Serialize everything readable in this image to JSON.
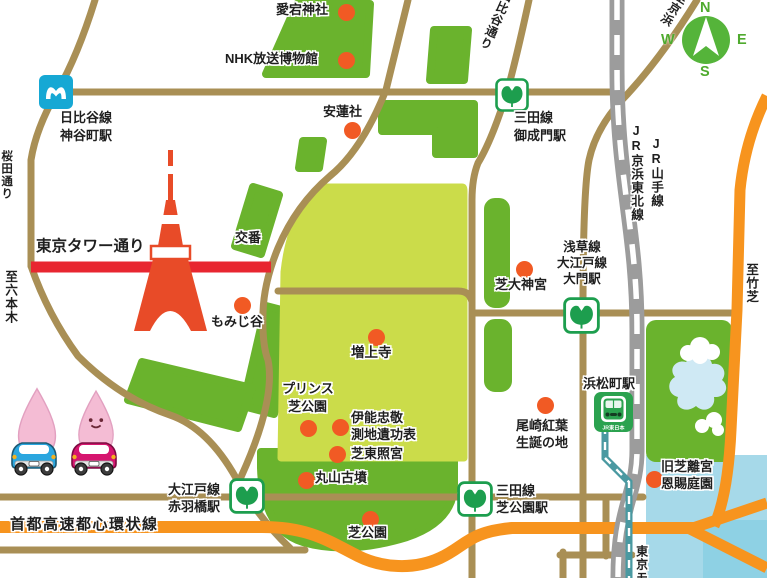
{
  "colors": {
    "park_green": "#6ab32d",
    "lawn_green": "#cbdc4a",
    "road_tan": "#a98f55",
    "red_road": "#e82630",
    "expressway_orange": "#f7941e",
    "water": "#a6d9e9",
    "water_deep": "#8ed1e4",
    "jr_rail_gray": "#9c9c9c",
    "monorail_teal": "#4a99a1",
    "metro_blue": "#16a8d4",
    "toei_green": "#1d9e4e",
    "jr_station_green": "#2ba24f",
    "compass_green": "#55b43a",
    "poi_dot_orange": "#f15a24",
    "tower_red": "#e84b28",
    "mascot_pink": "#f4bcd4",
    "car_blue": "#2aa6df",
    "car_pink": "#d6156f"
  },
  "compass": {
    "n": "N",
    "e": "E",
    "s": "S",
    "w": "W"
  },
  "streets": {
    "tokyo_tower_street": "東京タワー通り",
    "expressway": "首都高速都心環状線",
    "sakurada": "桜田通り",
    "hibiya": "日比谷通り",
    "to_roppongi": "至六本木",
    "to_takeshiba": "至竹芝",
    "to_keihin": "至京浜",
    "jr_keihin_tohoku": "JR京浜東北線",
    "jr_yamanote": "JR山手線",
    "monorail": "東京モ",
    "police_box": "交番"
  },
  "stations": {
    "kamiyacho": {
      "line": "日比谷線",
      "name": "神谷町駅"
    },
    "onarimon": {
      "line": "三田線",
      "name": "御成門駅"
    },
    "daimon": {
      "line1": "浅草線",
      "line2": "大江戸線",
      "name": "大門駅"
    },
    "akabanebashi": {
      "line": "大江戸線",
      "name": "赤羽橋駅"
    },
    "shibakoen": {
      "line": "三田線",
      "name": "芝公園駅"
    },
    "hamamatsucho": {
      "name": "浜松町駅",
      "operator": "JR東日本"
    }
  },
  "pois": {
    "atago": "愛宕神社",
    "nhk": "NHK放送博物館",
    "anrenja": "安蓮社",
    "shiba_daijingu": "芝大神宮",
    "momijidani": "もみじ谷",
    "zojoji": "増上寺",
    "prince1": "プリンス",
    "prince2": "芝公園",
    "inou1": "伊能忠敬",
    "inou2": "測地遺功表",
    "toshogu": "芝東照宮",
    "maruyama": "丸山古墳",
    "shibakoen_park": "芝公園",
    "ozaki1": "尾崎紅葉",
    "ozaki2": "生誕の地",
    "kyushiba1": "旧芝離宮",
    "kyushiba2": "恩賜庭園"
  }
}
